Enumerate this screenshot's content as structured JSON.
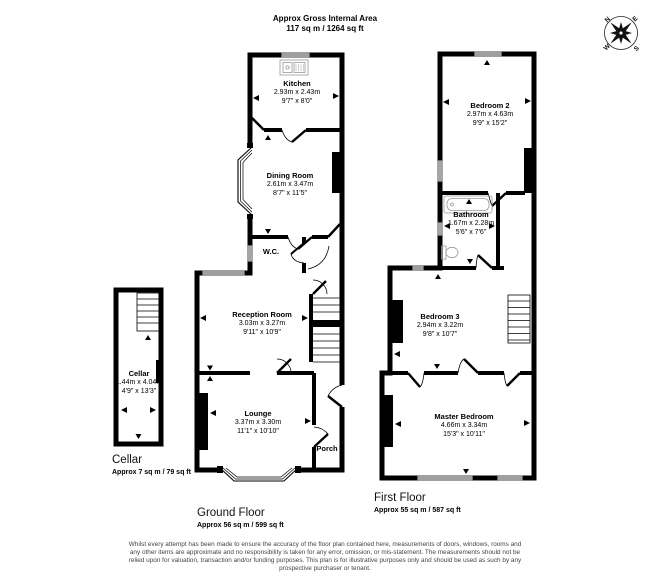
{
  "header": {
    "title": "Approx Gross Internal Area",
    "area": "117 sq m / 1264 sq ft"
  },
  "compass": {
    "n": "N",
    "e": "E",
    "s": "S",
    "w": "W"
  },
  "rooms": {
    "cellar": {
      "name": "Cellar",
      "metric": "1.44m x 4.04m",
      "imperial": "4'9\" x 13'3\""
    },
    "kitchen": {
      "name": "Kitchen",
      "metric": "2.93m x 2.43m",
      "imperial": "9'7\" x 8'0\""
    },
    "dining": {
      "name": "Dining Room",
      "metric": "2.61m x 3.47m",
      "imperial": "8'7\" x 11'5\""
    },
    "wc": {
      "name": "W.C."
    },
    "reception": {
      "name": "Reception Room",
      "metric": "3.03m x 3.27m",
      "imperial": "9'11\" x 10'9\""
    },
    "lounge": {
      "name": "Lounge",
      "metric": "3.37m x 3.30m",
      "imperial": "11'1\" x 10'10\""
    },
    "porch": {
      "name": "Porch"
    },
    "bedroom2": {
      "name": "Bedroom 2",
      "metric": "2.97m x 4.63m",
      "imperial": "9'9\" x 15'2\""
    },
    "bathroom": {
      "name": "Bathroom",
      "metric": "1.67m x 2.28m",
      "imperial": "5'6\" x 7'6\""
    },
    "bedroom3": {
      "name": "Bedroom 3",
      "metric": "2.94m x 3.22m",
      "imperial": "9'8\" x 10'7\""
    },
    "master": {
      "name": "Master Bedroom",
      "metric": "4.66m x 3.34m",
      "imperial": "15'3\" x 10'11\""
    }
  },
  "captions": {
    "cellar": {
      "label": "Cellar",
      "area": "Approx 7 sq m / 79 sq ft"
    },
    "ground": {
      "label": "Ground Floor",
      "area": "Approx 56 sq m / 599 sq ft"
    },
    "first": {
      "label": "First Floor",
      "area": "Approx 55 sq m / 587 sq ft"
    }
  },
  "disclaimer": {
    "lines": [
      "Whilst every attempt has been made to ensure the accuracy of the floor plan contained here, measurements of doors, windows, rooms and",
      "any other items are approximate and no responsibility is taken for any error, omission, or mis-statement. The measurements should not be",
      "relied upon for valuation, transaction and/or funding purposes. This plan is for illustrative purposes only and should be used as such by any",
      "prospective purchaser or tenant."
    ]
  },
  "colors": {
    "wall": "#000000",
    "fixture": "#999999",
    "text_muted": "#444444"
  }
}
